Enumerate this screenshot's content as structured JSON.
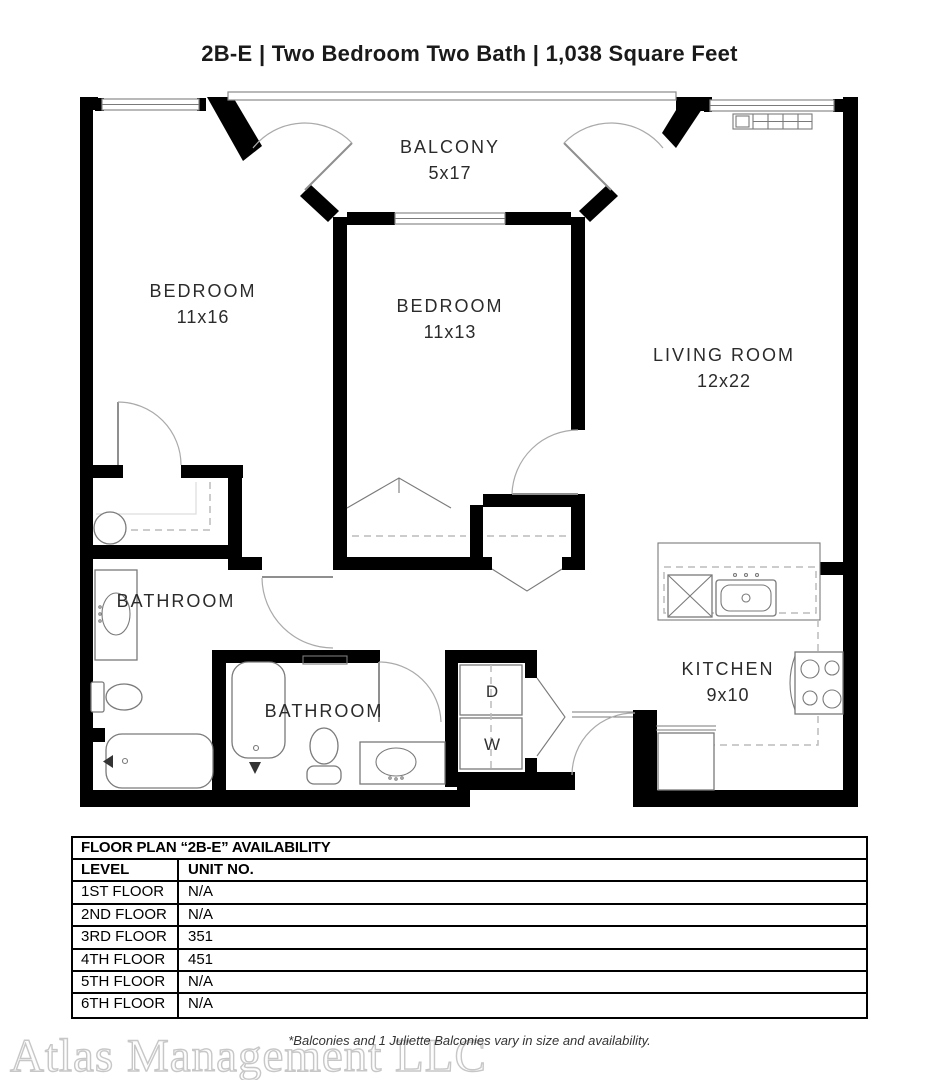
{
  "title": "2B-E | Two Bedroom Two Bath | 1,038 Square Feet",
  "floor_plan": {
    "rooms": [
      {
        "name": "BALCONY",
        "dims": "5x17"
      },
      {
        "name": "BEDROOM",
        "dims": "11x16"
      },
      {
        "name": "BEDROOM",
        "dims": "11x13"
      },
      {
        "name": "LIVING ROOM",
        "dims": "12x22"
      },
      {
        "name": "BATHROOM",
        "dims": ""
      },
      {
        "name": "BATHROOM",
        "dims": ""
      },
      {
        "name": "KITCHEN",
        "dims": "9x10"
      }
    ],
    "appliances": {
      "dryer": "D",
      "washer": "W"
    }
  },
  "availability_table": {
    "title": "FLOOR PLAN “2B-E” AVAILABILITY",
    "columns": [
      "LEVEL",
      "UNIT NO."
    ],
    "rows": [
      [
        "1ST FLOOR",
        "N/A"
      ],
      [
        "2ND FLOOR",
        "N/A"
      ],
      [
        "3RD FLOOR",
        "351"
      ],
      [
        "4TH FLOOR",
        "451"
      ],
      [
        "5TH FLOOR",
        "N/A"
      ],
      [
        "6TH FLOOR",
        "N/A"
      ]
    ]
  },
  "footer": {
    "watermark": "Atlas Management LLC",
    "disclaimer": "*Balconies and 1 Juliette Balconies vary in size and availability."
  },
  "colors": {
    "wall": "#000000",
    "thin_line": "#8a8a8a",
    "dash_line": "#bcbcbc",
    "text": "#2b2b2b",
    "watermark": "#c7c7c7"
  }
}
